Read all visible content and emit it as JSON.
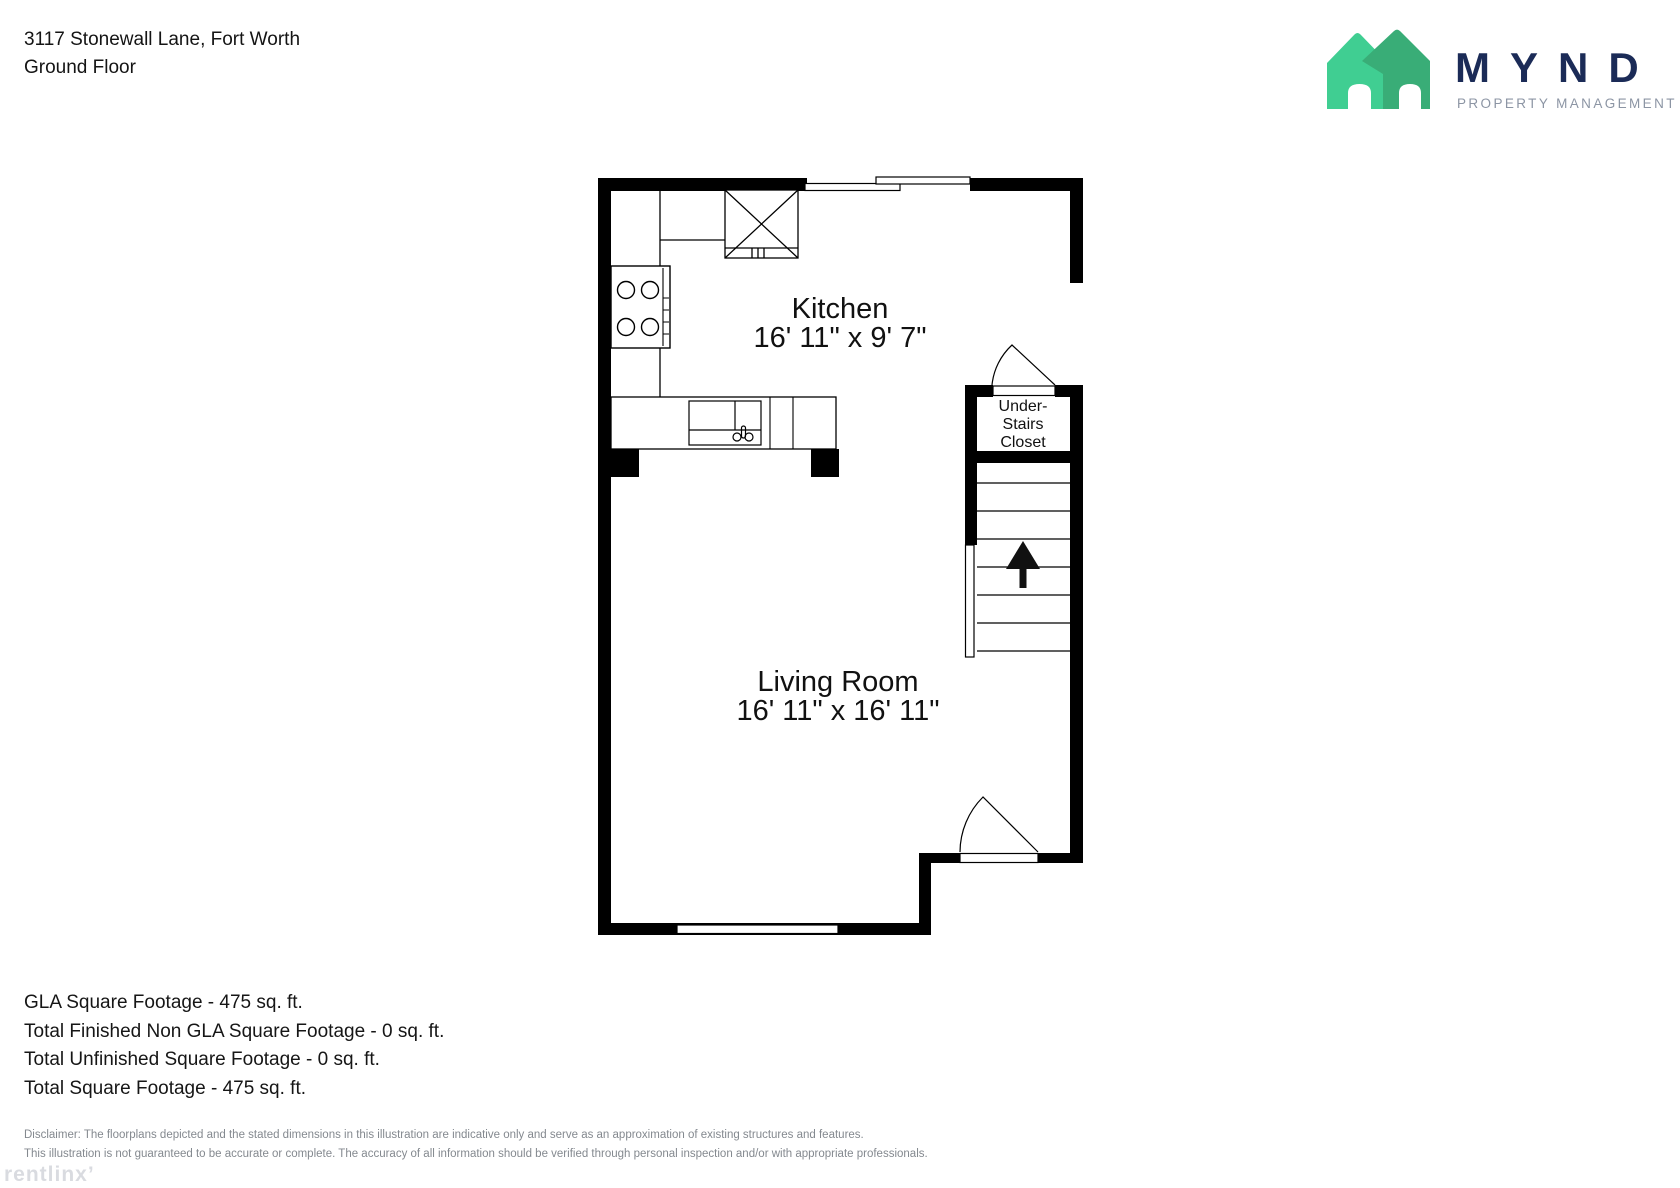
{
  "header": {
    "address": "3117 Stonewall Lane, Fort Worth",
    "floor_label": "Ground Floor"
  },
  "logo": {
    "brand": "MYND",
    "tagline": "PROPERTY MANAGEMENT",
    "colors": {
      "house_light": "#40CE92",
      "house_dark": "#39AD77",
      "brand_navy": "#1B2B57",
      "tagline_gray": "#8C95A4"
    }
  },
  "floorplan": {
    "rooms": [
      {
        "name": "Kitchen",
        "dims": "16' 11\" x 9' 7\""
      },
      {
        "name": "Living Room",
        "dims": "16' 11\" x 16' 11\""
      }
    ],
    "closet": {
      "lines": [
        "Under-",
        "Stairs",
        "Closet"
      ]
    },
    "stairs": {
      "icon": "up-arrow"
    }
  },
  "footer": {
    "stats": [
      "GLA Square Footage - 475 sq. ft.",
      "Total Finished Non GLA Square Footage - 0 sq. ft.",
      "Total Unfinished Square Footage - 0 sq. ft.",
      "Total Square Footage - 475 sq. ft."
    ],
    "disclaimer": [
      "Disclaimer: The floorplans depicted and the stated dimensions in this illustration are indicative only and serve as an approximation of existing structures and features.",
      "This illustration is not guaranteed to be accurate or complete. The accuracy of all information should be verified through personal inspection and/or with appropriate professionals."
    ],
    "watermark": "rentlinx’"
  }
}
